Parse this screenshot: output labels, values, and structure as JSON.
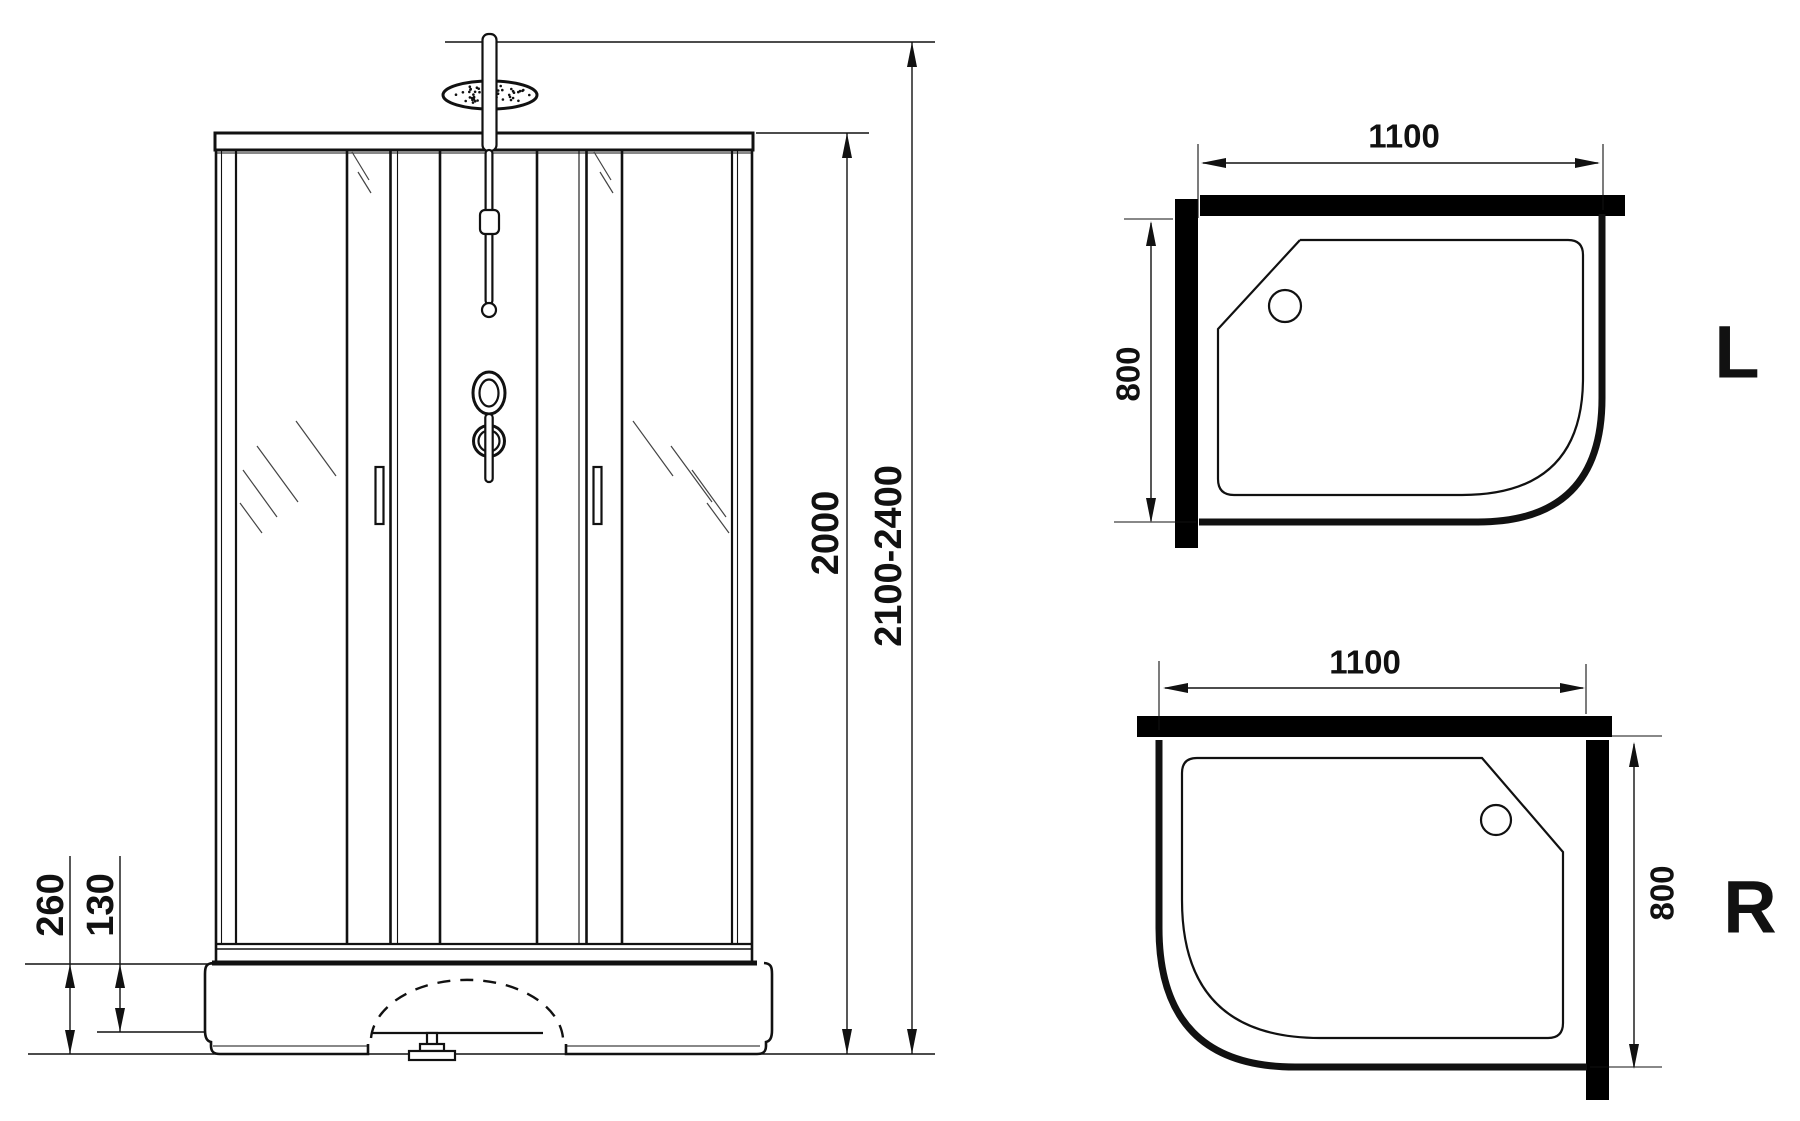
{
  "drawing": {
    "front": {
      "dim_base_height": "260",
      "dim_base_inner_height": "130",
      "dim_cabin_height": "2000",
      "dim_total_height_range": "2100-2400"
    },
    "plan_left": {
      "dim_width": "1100",
      "dim_depth": "800",
      "orientation_label": "L"
    },
    "plan_right": {
      "dim_width": "1100",
      "dim_depth": "800",
      "orientation_label": "R"
    }
  },
  "colors": {
    "line": "#111111",
    "wall_fill": "#000000",
    "background": "#ffffff"
  }
}
